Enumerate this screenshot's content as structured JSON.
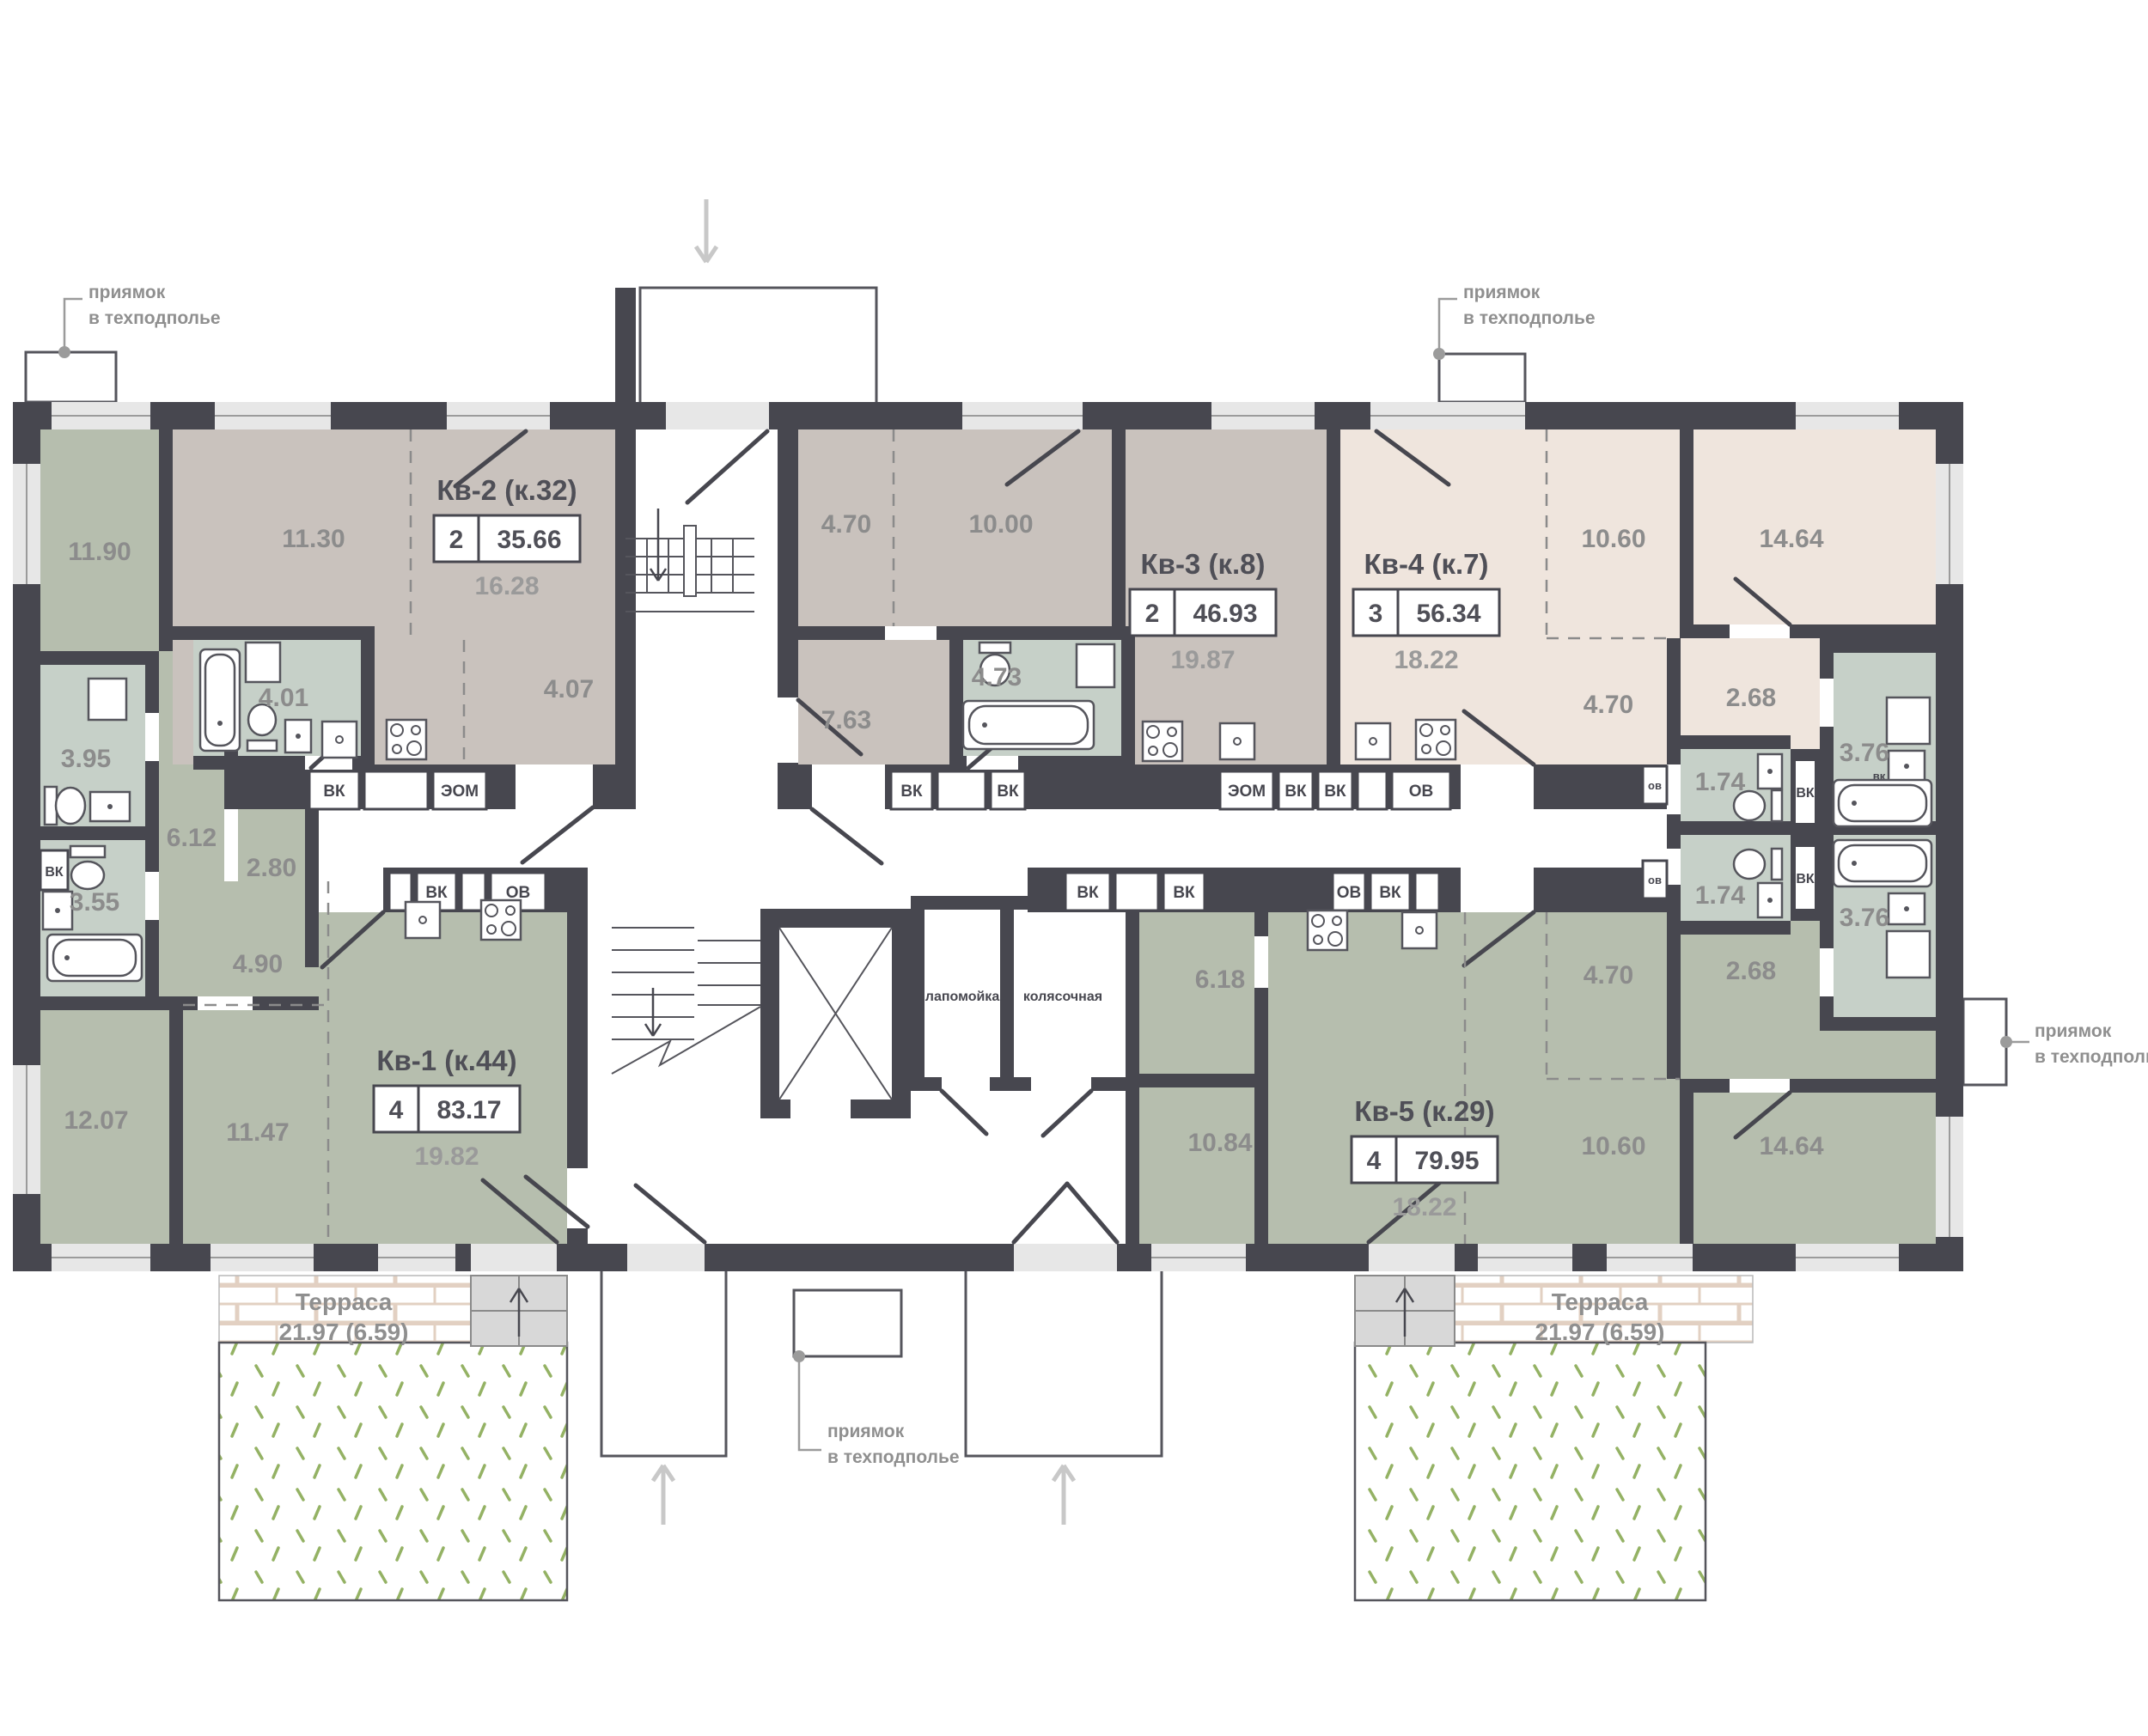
{
  "labels": {
    "vk": "ВК",
    "eom": "ЭОМ",
    "ov": "ОВ",
    "vk_small": "вк",
    "ov_small": "ов"
  },
  "annotations": {
    "pit_line1": "приямок",
    "pit_line2": "в техподполье"
  },
  "common": {
    "paw_wash": "лапомойка",
    "stroller": "колясочная"
  },
  "terrace": {
    "name": "Терраса",
    "area": "21.97 (6.59)"
  },
  "apartments": [
    {
      "id": "kv-1",
      "title": "Кв-1 (к.44)",
      "rooms": "4",
      "total": "83.17",
      "living": "19.82",
      "areas": {
        "room_1190": "11.90",
        "bath_395": "3.95",
        "hall_612": "6.12",
        "bath_355": "3.55",
        "ward_280": "2.80",
        "room_1207": "12.07",
        "room_1147": "11.47",
        "kitchen_490": "4.90"
      }
    },
    {
      "id": "kv-2",
      "title": "Кв-2 (к.32)",
      "rooms": "2",
      "total": "35.66",
      "living": "16.28",
      "areas": {
        "room_1130": "11.30",
        "bath_401": "4.01",
        "hall_407": "4.07"
      }
    },
    {
      "id": "kv-3",
      "title": "Кв-3 (к.8)",
      "rooms": "2",
      "total": "46.93",
      "living": "19.87",
      "areas": {
        "hall_470": "4.70",
        "room_1000": "10.00",
        "room_763": "7.63",
        "bath_473": "4.73"
      }
    },
    {
      "id": "kv-4",
      "title": "Кв-4 (к.7)",
      "rooms": "3",
      "total": "56.34",
      "living": "18.22",
      "areas": {
        "room_1060": "10.60",
        "room_1464": "14.64",
        "hall_470": "4.70",
        "hall_268": "2.68",
        "wc_174": "1.74",
        "bath_376": "3.76"
      }
    },
    {
      "id": "kv-5",
      "title": "Кв-5 (к.29)",
      "rooms": "4",
      "total": "79.95",
      "living": "18.22",
      "areas": {
        "room_618": "6.18",
        "room_1084": "10.84",
        "room_1060": "10.60",
        "room_1464": "14.64",
        "hall_470": "4.70",
        "hall_268": "2.68",
        "wc_174": "1.74",
        "bath_376": "3.76"
      }
    }
  ],
  "colors": {
    "wall": "#47474f",
    "sage": "#b6beae",
    "taupe": "#c9c2bd",
    "cream": "#efe5dd",
    "bathroom": "#c6d0c8",
    "lawn": "#94b264",
    "brick_line": "#e2d0c2"
  }
}
